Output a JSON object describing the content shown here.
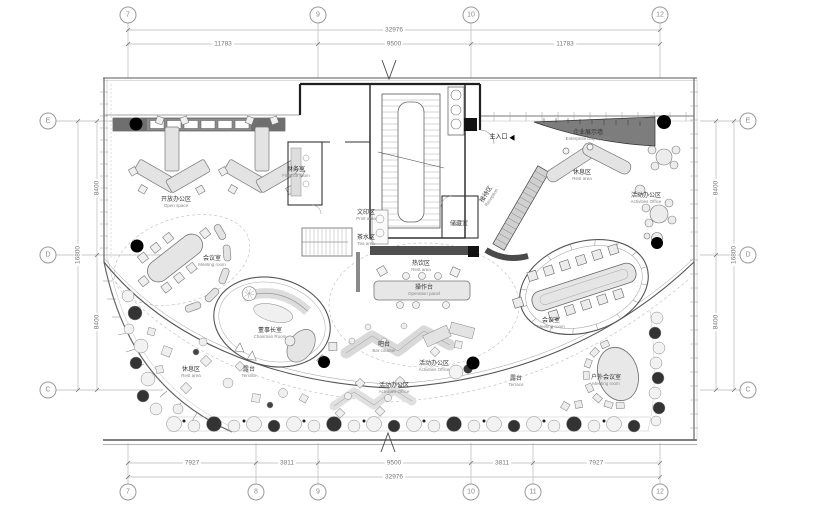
{
  "palette": {
    "line": "#555555",
    "light_fill": "#e5e5e5",
    "dark_wall": "#7d7d7d",
    "black": "#000000",
    "annotation": "#9a9a9a"
  },
  "grid": {
    "top": {
      "bubbles": [
        "7",
        "9",
        "10",
        "12"
      ],
      "total": "32976",
      "segments": [
        "11783",
        "9500",
        "11783"
      ]
    },
    "bottom": {
      "bubbles": [
        "7",
        "8",
        "9",
        "10",
        "11",
        "12"
      ],
      "segments": [
        "7927",
        "3811",
        "9500",
        "3811",
        "7927"
      ],
      "total": "32976"
    },
    "left": {
      "bubbles": [
        "E",
        "D",
        "C"
      ],
      "segments": [
        "8400",
        "8400"
      ],
      "total": "16800"
    },
    "right": {
      "bubbles": [
        "E",
        "D",
        "C"
      ],
      "segments": [
        "8400",
        "8400"
      ],
      "total": "16800"
    }
  },
  "rooms": {
    "open_space": {
      "cn": "开放办公区",
      "en": "Open space"
    },
    "meeting_left": {
      "cn": "会议室",
      "en": "Meeting room"
    },
    "finance": {
      "cn": "财务室",
      "en": "Finance room"
    },
    "print": {
      "cn": "文印区",
      "en": "Print area"
    },
    "tea": {
      "cn": "茶水区",
      "en": "Tea area"
    },
    "storage": {
      "cn": "储藏室",
      "en": ""
    },
    "entrance": {
      "cn": "主入口",
      "en": ""
    },
    "reception": {
      "cn": "接待区",
      "en": "Reception"
    },
    "display_wall": {
      "cn": "企业展示墙",
      "en": "Enterprise display wall"
    },
    "rest_right": {
      "cn": "休息区",
      "en": "Rest area"
    },
    "activities_right": {
      "cn": "活动办公区",
      "en": "Activities Office"
    },
    "hot_drink": {
      "cn": "热饮区",
      "en": "Rest area"
    },
    "operation": {
      "cn": "操作台",
      "en": "Operation panel"
    },
    "meeting_oval": {
      "cn": "会议室",
      "en": "Meeting room"
    },
    "chairman": {
      "cn": "董事长室",
      "en": "Chairman Room"
    },
    "bar": {
      "cn": "吧台",
      "en": "Bar counter"
    },
    "activities_c1": {
      "cn": "活动办公区",
      "en": "Activities Office"
    },
    "activities_c2": {
      "cn": "活动办公区",
      "en": "Activities Office"
    },
    "rest_left": {
      "cn": "休息区",
      "en": "Rest area"
    },
    "terrace_left": {
      "cn": "露台",
      "en": "Terrace"
    },
    "terrace_right": {
      "cn": "露台",
      "en": "Terrace"
    },
    "outdoor_meeting": {
      "cn": "户外会议室",
      "en": "Meeting room"
    }
  }
}
